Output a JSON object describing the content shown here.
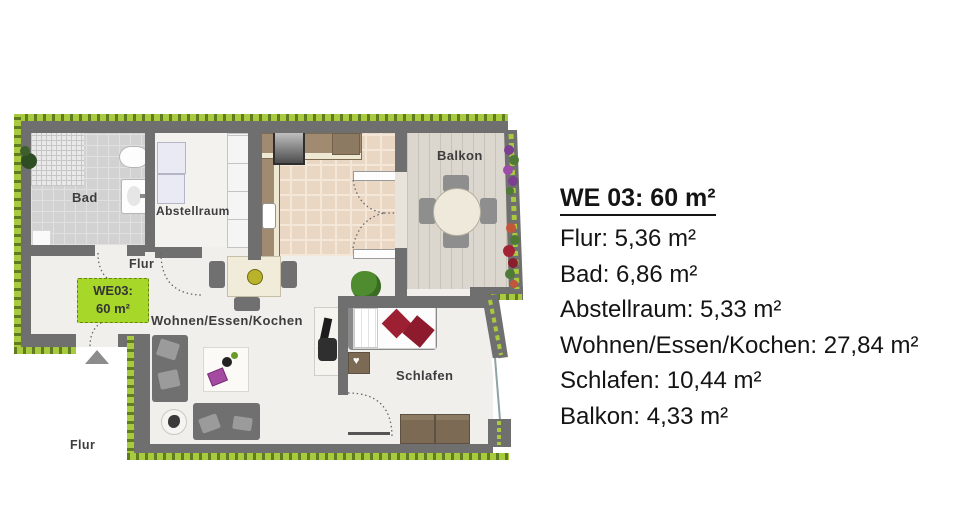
{
  "legend": {
    "title": "WE 03: 60 m²",
    "items": [
      "Flur: 5,36 m²",
      "Bad: 6,86 m²",
      "Abstellraum: 5,33 m²",
      "Wohnen/Essen/Kochen: 27,84 m²",
      "Schlafen: 10,44 m²",
      "Balkon: 4,33 m²"
    ]
  },
  "unit": {
    "id": "WE 03",
    "total_area": "60 m²",
    "rooms": [
      {
        "name": "Flur",
        "area": "5,36 m²"
      },
      {
        "name": "Bad",
        "area": "6,86 m²"
      },
      {
        "name": "Abstellraum",
        "area": "5,33 m²"
      },
      {
        "name": "Wohnen/Essen/Kochen",
        "area": "27,84 m²"
      },
      {
        "name": "Schlafen",
        "area": "10,44 m²"
      },
      {
        "name": "Balkon",
        "area": "4,33 m²"
      }
    ]
  },
  "plan": {
    "badge": {
      "line1": "WE03:",
      "line2": "60 m²"
    },
    "labels": {
      "bad": "Bad",
      "abstellraum": "Abstellraum",
      "flur": "Flur",
      "wohnen": "Wohnen/Essen/Kochen",
      "schlafen": "Schlafen",
      "balkon": "Balkon",
      "corridor_flur": "Flur"
    }
  },
  "colors": {
    "hedge_green": "#a9ca3e",
    "hedge_dark": "#5e7d20",
    "wall_gray": "#6f6f6f",
    "badge_green": "#a7d829",
    "red_cushion": "#9c1f32",
    "kitchen_tile": "#e9d6c3",
    "bad_tile": "#d2d2d2",
    "balcony_floor": "#dbd7ce",
    "living_floor": "#f0efec"
  }
}
